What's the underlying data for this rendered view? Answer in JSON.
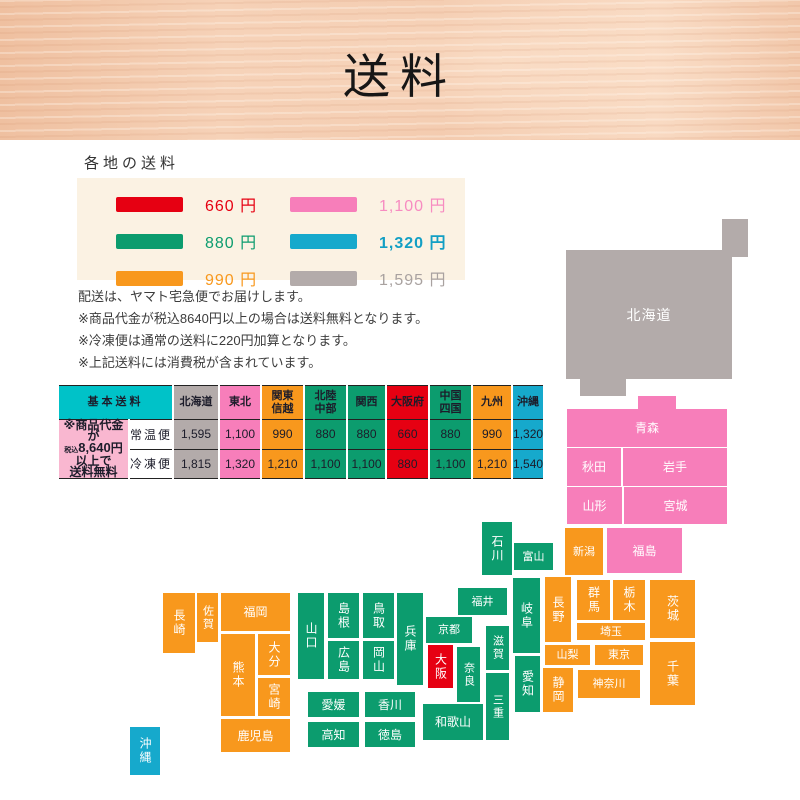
{
  "header": {
    "title": "送料"
  },
  "legend": {
    "heading": "各地の送料",
    "items": [
      {
        "label": "660 円",
        "color": "#e60012",
        "key": "red"
      },
      {
        "label": "1,100 円",
        "color": "#f77eba",
        "key": "pink"
      },
      {
        "label": "880 円",
        "color": "#0c9c6e",
        "key": "green"
      },
      {
        "label": "1,320 円",
        "color": "#16a9cc",
        "key": "blue"
      },
      {
        "label": "990 円",
        "color": "#f8981d",
        "key": "orange"
      },
      {
        "label": "1,595 円",
        "color": "#b3abaa",
        "key": "gray"
      }
    ]
  },
  "notes": {
    "line1": "配送は、ヤマト宅急便でお届けします。",
    "line2": "※商品代金が税込8640円以上の場合は送料無料となります。",
    "line3": "※冷凍便は通常の送料に220円加算となります。",
    "line4": "※上記送料には消費税が含まれています。"
  },
  "table": {
    "corner": "基本送料",
    "note": {
      "l1": "※商品代金が",
      "l2a": "税込",
      "l2b": "8,640",
      "l2c": "円以上で",
      "l3": "送料無料"
    },
    "row_labels": {
      "normal": "常温便",
      "frozen": "冷凍便"
    },
    "columns": [
      {
        "label": "北海道",
        "normal": "1,595",
        "frozen": "1,815",
        "key": "gray"
      },
      {
        "label": "東北",
        "normal": "1,100",
        "frozen": "1,320",
        "key": "pink"
      },
      {
        "label": "関東\n信越",
        "normal": "990",
        "frozen": "1,210",
        "key": "orange"
      },
      {
        "label": "北陸\n中部",
        "normal": "880",
        "frozen": "1,100",
        "key": "green"
      },
      {
        "label": "関西",
        "normal": "880",
        "frozen": "1,100",
        "key": "green"
      },
      {
        "label": "大阪府",
        "normal": "660",
        "frozen": "880",
        "key": "red"
      },
      {
        "label": "中国\n四国",
        "normal": "880",
        "frozen": "1,100",
        "key": "green"
      },
      {
        "label": "九州",
        "normal": "990",
        "frozen": "1,210",
        "key": "orange"
      },
      {
        "label": "沖縄",
        "normal": "1,320",
        "frozen": "1,540",
        "key": "blue"
      }
    ]
  },
  "map": {
    "prefectures": [
      {
        "name": "北海道",
        "region_color": "#b3abaa"
      },
      {
        "name": "青森",
        "region_color": "#f77eba"
      },
      {
        "name": "秋田",
        "region_color": "#f77eba"
      },
      {
        "name": "岩手",
        "region_color": "#f77eba"
      },
      {
        "name": "山形",
        "region_color": "#f77eba"
      },
      {
        "name": "宮城",
        "region_color": "#f77eba"
      },
      {
        "name": "福島",
        "region_color": "#f77eba"
      },
      {
        "name": "新潟",
        "region_color": "#f8981d"
      },
      {
        "name": "長野",
        "region_color": "#f8981d"
      },
      {
        "name": "群馬",
        "region_color": "#f8981d"
      },
      {
        "name": "栃木",
        "region_color": "#f8981d"
      },
      {
        "name": "茨城",
        "region_color": "#f8981d"
      },
      {
        "name": "埼玉",
        "region_color": "#f8981d"
      },
      {
        "name": "山梨",
        "region_color": "#f8981d"
      },
      {
        "name": "東京",
        "region_color": "#f8981d"
      },
      {
        "name": "千葉",
        "region_color": "#f8981d"
      },
      {
        "name": "神奈川",
        "region_color": "#f8981d"
      },
      {
        "name": "静岡",
        "region_color": "#f8981d"
      },
      {
        "name": "石川",
        "region_color": "#0c9c6e"
      },
      {
        "name": "富山",
        "region_color": "#0c9c6e"
      },
      {
        "name": "福井",
        "region_color": "#0c9c6e"
      },
      {
        "name": "岐阜",
        "region_color": "#0c9c6e"
      },
      {
        "name": "愛知",
        "region_color": "#0c9c6e"
      },
      {
        "name": "京都",
        "region_color": "#0c9c6e"
      },
      {
        "name": "滋賀",
        "region_color": "#0c9c6e"
      },
      {
        "name": "奈良",
        "region_color": "#0c9c6e"
      },
      {
        "name": "三重",
        "region_color": "#0c9c6e"
      },
      {
        "name": "和歌山",
        "region_color": "#0c9c6e"
      },
      {
        "name": "兵庫",
        "region_color": "#0c9c6e"
      },
      {
        "name": "山口",
        "region_color": "#0c9c6e"
      },
      {
        "name": "島根",
        "region_color": "#0c9c6e"
      },
      {
        "name": "鳥取",
        "region_color": "#0c9c6e"
      },
      {
        "name": "広島",
        "region_color": "#0c9c6e"
      },
      {
        "name": "岡山",
        "region_color": "#0c9c6e"
      },
      {
        "name": "愛媛",
        "region_color": "#0c9c6e"
      },
      {
        "name": "香川",
        "region_color": "#0c9c6e"
      },
      {
        "name": "高知",
        "region_color": "#0c9c6e"
      },
      {
        "name": "徳島",
        "region_color": "#0c9c6e"
      },
      {
        "name": "大阪",
        "region_color": "#e60012"
      },
      {
        "name": "福岡",
        "region_color": "#f8981d"
      },
      {
        "name": "佐賀",
        "region_color": "#f8981d"
      },
      {
        "name": "長崎",
        "region_color": "#f8981d"
      },
      {
        "name": "熊本",
        "region_color": "#f8981d"
      },
      {
        "name": "大分",
        "region_color": "#f8981d"
      },
      {
        "name": "宮崎",
        "region_color": "#f8981d"
      },
      {
        "name": "鹿児島",
        "region_color": "#f8981d"
      },
      {
        "name": "沖縄",
        "region_color": "#16a9cc"
      }
    ]
  }
}
